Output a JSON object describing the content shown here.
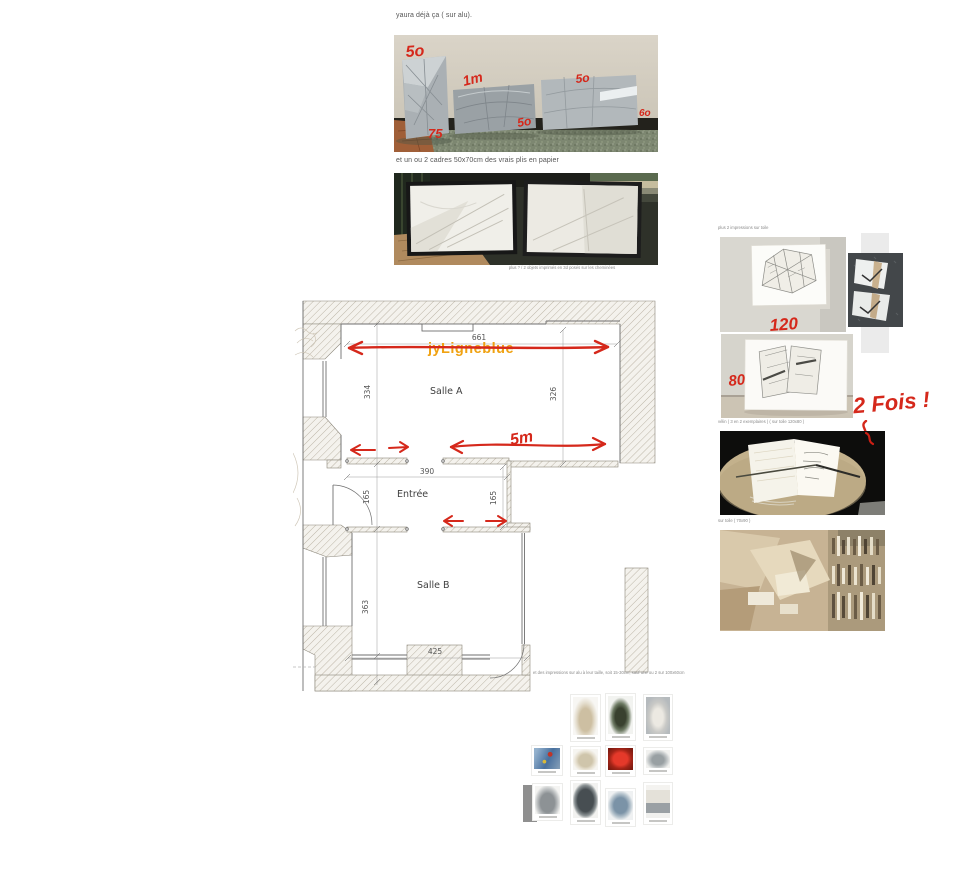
{
  "colors": {
    "annotation_red": "#d5281b",
    "watermark_orange": "#f0a212"
  },
  "post1": {
    "intro": "yaura déjà ça ( sur alu).",
    "ann_top_left": "5o",
    "ann_1m": "1m",
    "ann_top_right": "5o",
    "ann_bottom_left": "75",
    "ann_bottom_mid": "5o",
    "ann_right_edge": "6o"
  },
  "post2": {
    "intro": "et un ou 2 cadres  50x70cm des vrais plis en papier",
    "caption": "plus ? / 2 objets imprimés en 3d posés sur les cheminées"
  },
  "floorplan": {
    "watermark": "jyLigneblue",
    "room_a": "Salle A",
    "room_b": "Salle B",
    "entry": "Entrée",
    "dim_top": "661",
    "dim_a_left": "334",
    "dim_a_right": "326",
    "dim_entry_width": "390",
    "dim_entry_left": "165",
    "dim_entry_right": "165",
    "dim_b_left": "363",
    "dim_b_bottom": "425",
    "note_5m": "5m"
  },
  "right_col": {
    "caption_top": "plus 2 impressions sur toile",
    "note_120": "120",
    "note_80": "80",
    "caption_mid": "vélin ( 3 en 2 exemplaires ) ( sur toile 120x80 )",
    "caption_book": "sur toile ( 70x90 )",
    "note_2fois": "2 Fois !"
  },
  "bottom": {
    "intro": "et des impressions sur alu à leur taille, soit 15-30cm, sauf une ou 2 sur 100x60cm"
  }
}
